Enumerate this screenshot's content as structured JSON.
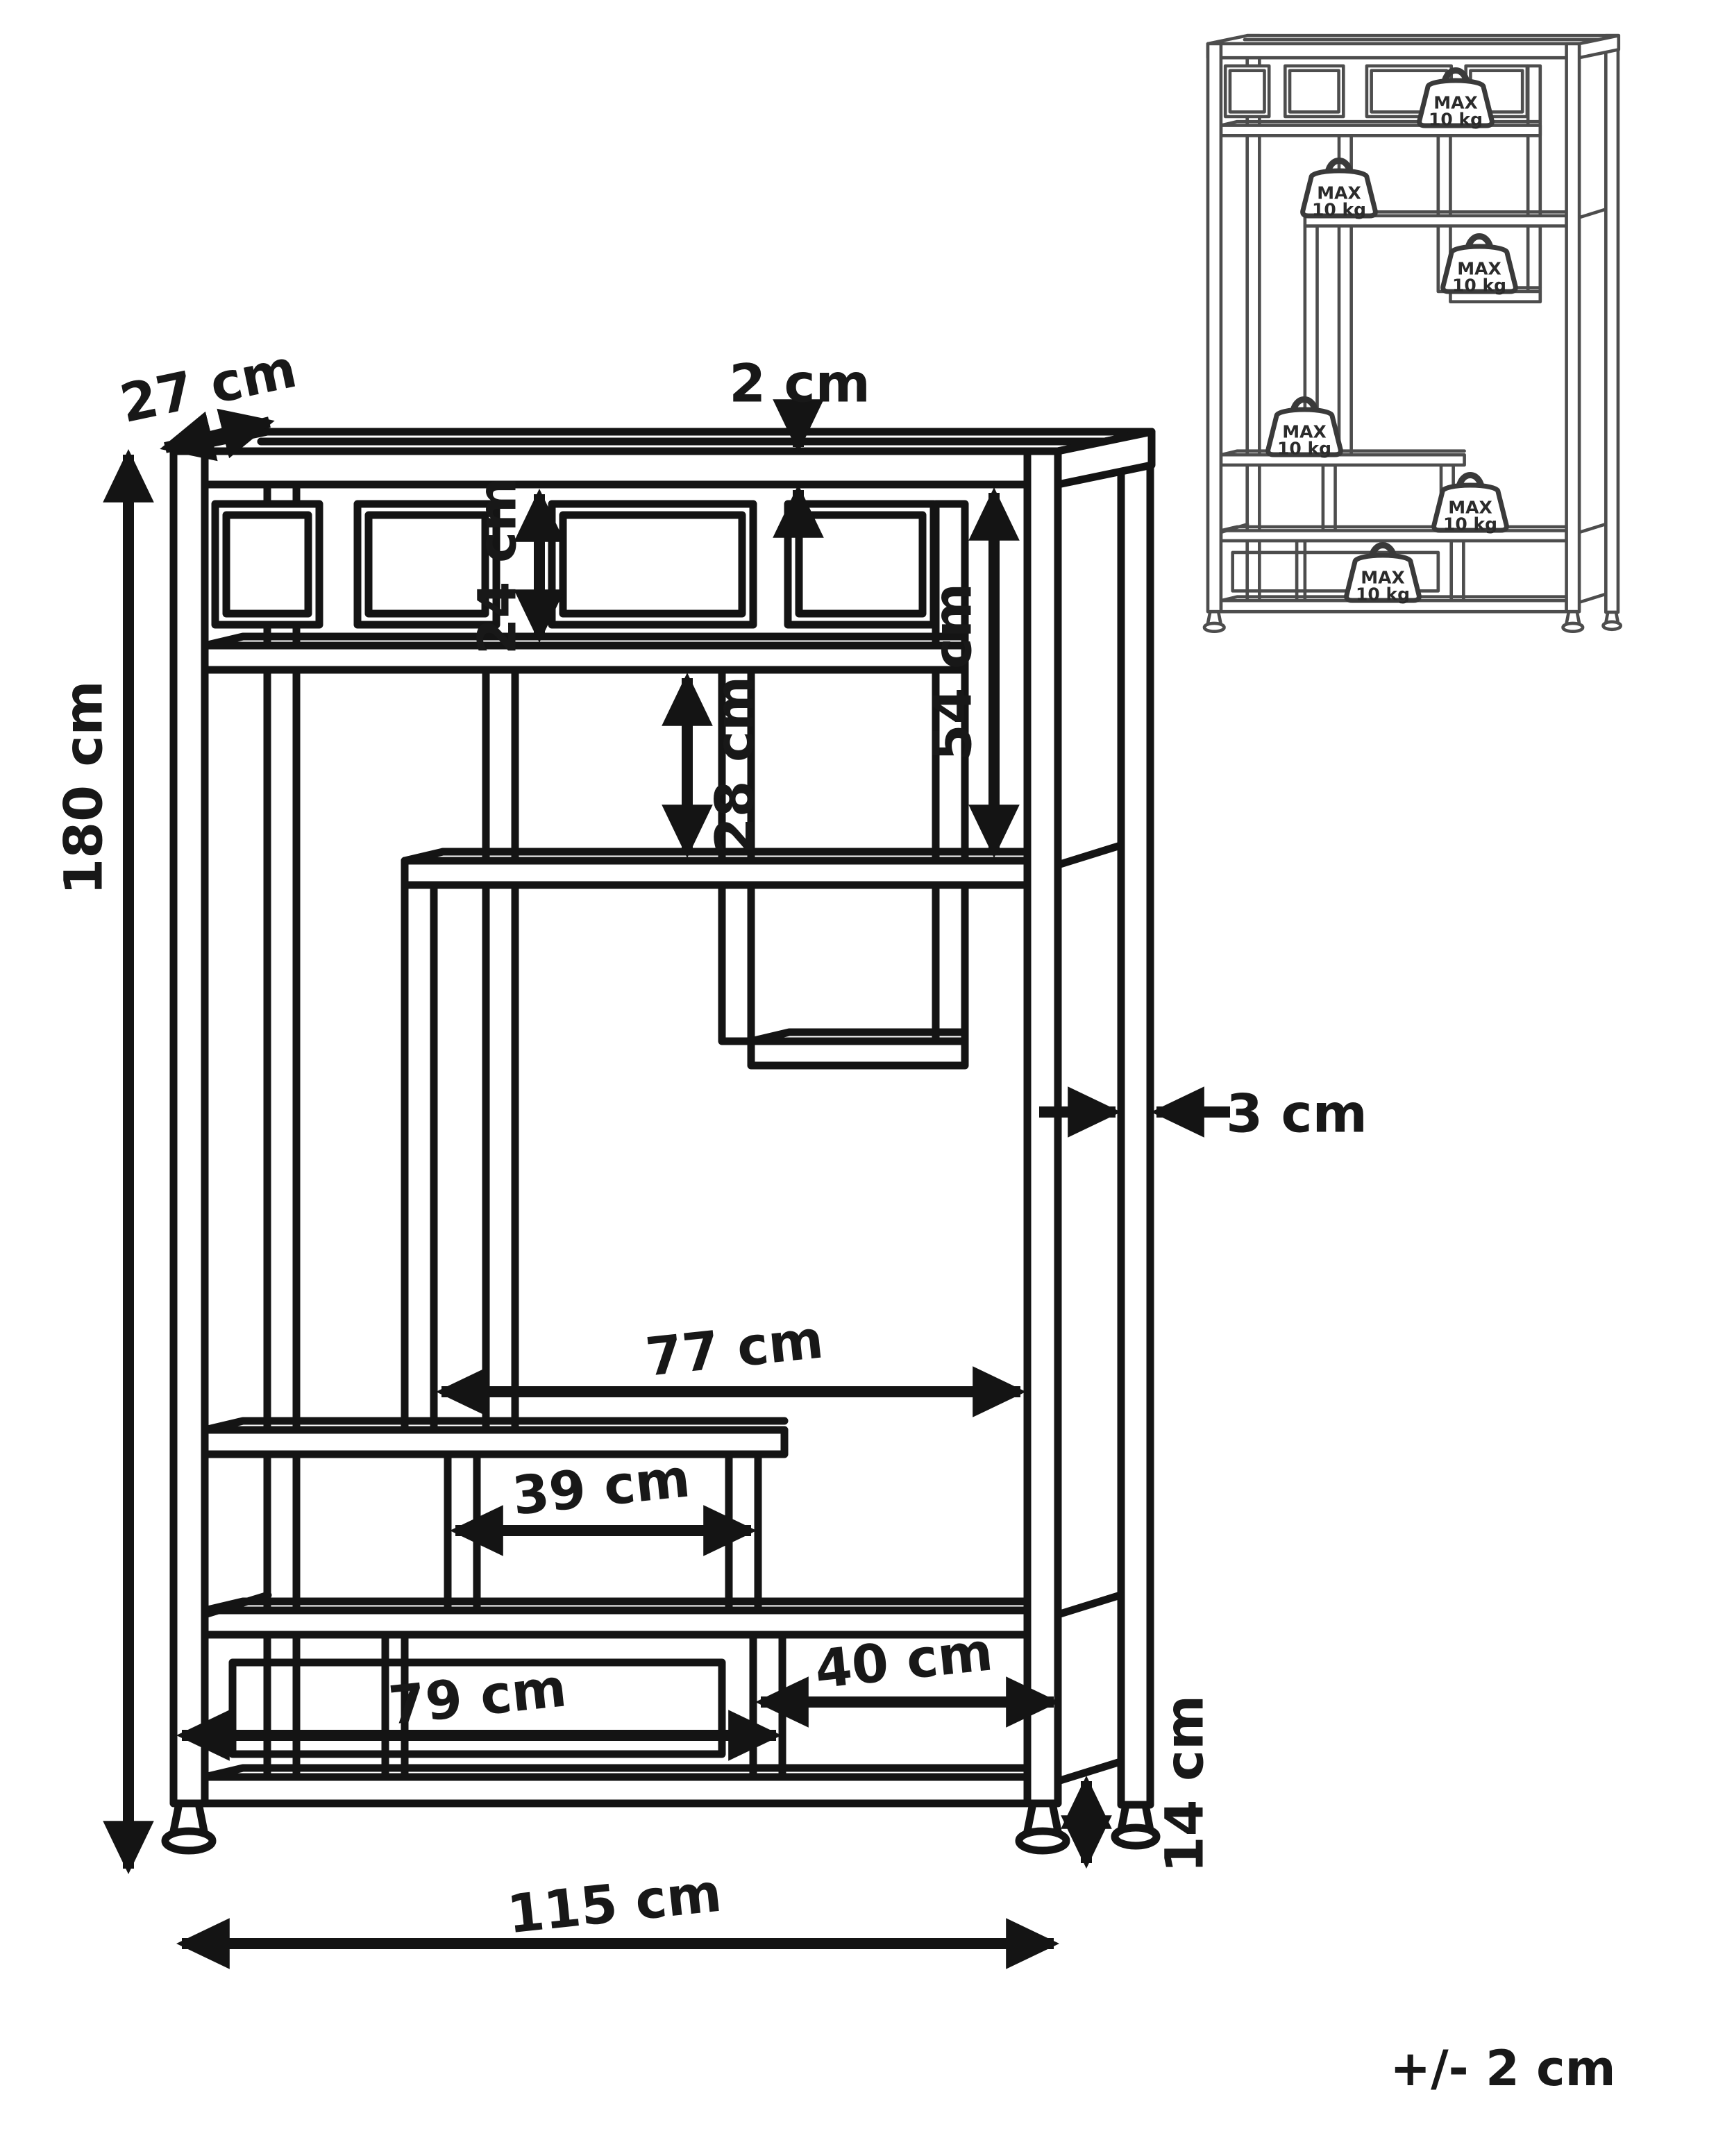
{
  "diagram": {
    "title_hint": "shelving unit dimension drawing",
    "dimensions": {
      "depth": {
        "label": "27 cm"
      },
      "top_panel_thickness": {
        "label": "2 cm"
      },
      "top_row_height": {
        "label": "24 cm"
      },
      "middle_box_height": {
        "label": "28 cm"
      },
      "right_opening_height": {
        "label": "54 cm"
      },
      "total_height": {
        "label": "180 cm"
      },
      "frame_thickness": {
        "label": "3 cm"
      },
      "middle_opening_width": {
        "label": "77 cm"
      },
      "small_box_width": {
        "label": "39 cm"
      },
      "bottom_left_compartment_width": {
        "label": "79 cm"
      },
      "bottom_right_compartment_width": {
        "label": "40 cm"
      },
      "foot_clearance_height": {
        "label": "14 cm"
      },
      "total_width": {
        "label": "115 cm"
      }
    },
    "tolerance_note": "+/- 2 cm",
    "load_badge": {
      "line1": "MAX",
      "line2": "10 kg",
      "count": 6
    },
    "colors": {
      "line": "#141414",
      "inset_line": "#4d4d4d",
      "background": "#ffffff"
    }
  }
}
